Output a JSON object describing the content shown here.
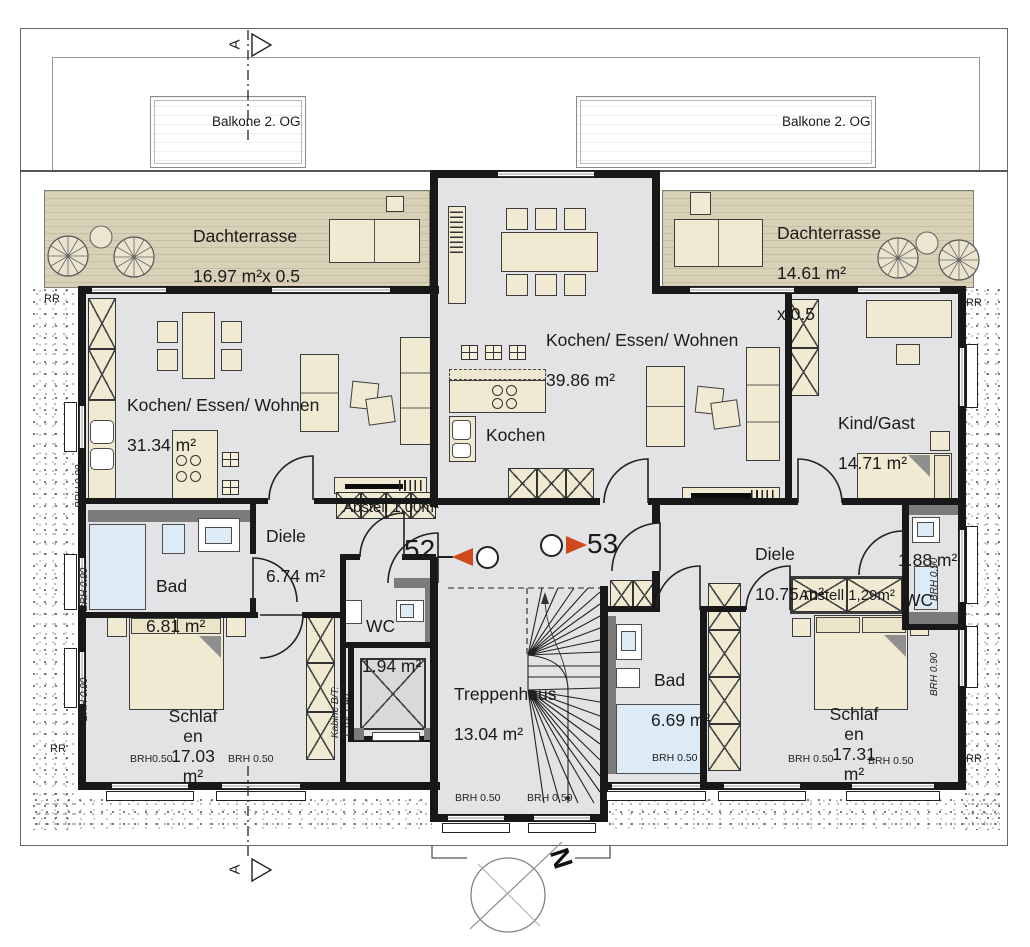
{
  "colors": {
    "wall": "#181818",
    "floor": "#e3e3e5",
    "terrace": "#d9d0b8",
    "furniture": "#f1ead3",
    "sanitary": "#dcebf5",
    "fixture_gray": "#7b7b7b",
    "marker_red": "#ce4a1d"
  },
  "balconies": {
    "left": "Balkone 2. OG",
    "right": "Balkone 2. OG"
  },
  "terraces": {
    "left": {
      "name": "Dachterrasse",
      "area": "16.97 m²x 0.5"
    },
    "right": {
      "name": "Dachterrasse",
      "area": "14.61 m²",
      "factor": "x 0.5"
    }
  },
  "apartments": {
    "left": {
      "number": "52"
    },
    "right": {
      "number": "53"
    }
  },
  "rooms": {
    "living_left": {
      "name": "Kochen/ Essen/ Wohnen",
      "area": "31.34 m²"
    },
    "living_right": {
      "name": "Kochen/ Essen/ Wohnen",
      "area": "39.86 m²"
    },
    "kochen": "Kochen",
    "kind_gast": {
      "name": "Kind/Gast",
      "area": "14.71 m²"
    },
    "diele_left": {
      "name": "Diele",
      "area": "6.74 m²"
    },
    "diele_right": {
      "name": "Diele",
      "area": "10.75 m²"
    },
    "bad_left": {
      "name": "Bad",
      "area": "6.81 m²"
    },
    "bad_right": {
      "name": "Bad",
      "area": "6.69 m²"
    },
    "wc_left": {
      "name": "WC",
      "area": "1.94 m²"
    },
    "wc_right": {
      "area": "1.88 m²",
      "name": "WC"
    },
    "abstell_left": "Abstell 1,00m²",
    "abstell_right": "Abstell 1,29m²",
    "schlafen_left": "Schlaf\nen\n17.03\nm²",
    "schlafen_right": "Schlaf\nen\n17.31\nm²",
    "treppenhaus": {
      "name": "Treppenhaus",
      "area": "13.04 m²"
    }
  },
  "elevator": {
    "label_line1": "Kabine B/T:",
    "label_line2": "1,10/ 1,40"
  },
  "annotations": {
    "brh_050": "BRH 0.50",
    "brh_050_tight": "BRH0.50",
    "brh_090": "BRH 0.90",
    "rr": "RR",
    "north_letter": "N",
    "section_letter": "A"
  }
}
